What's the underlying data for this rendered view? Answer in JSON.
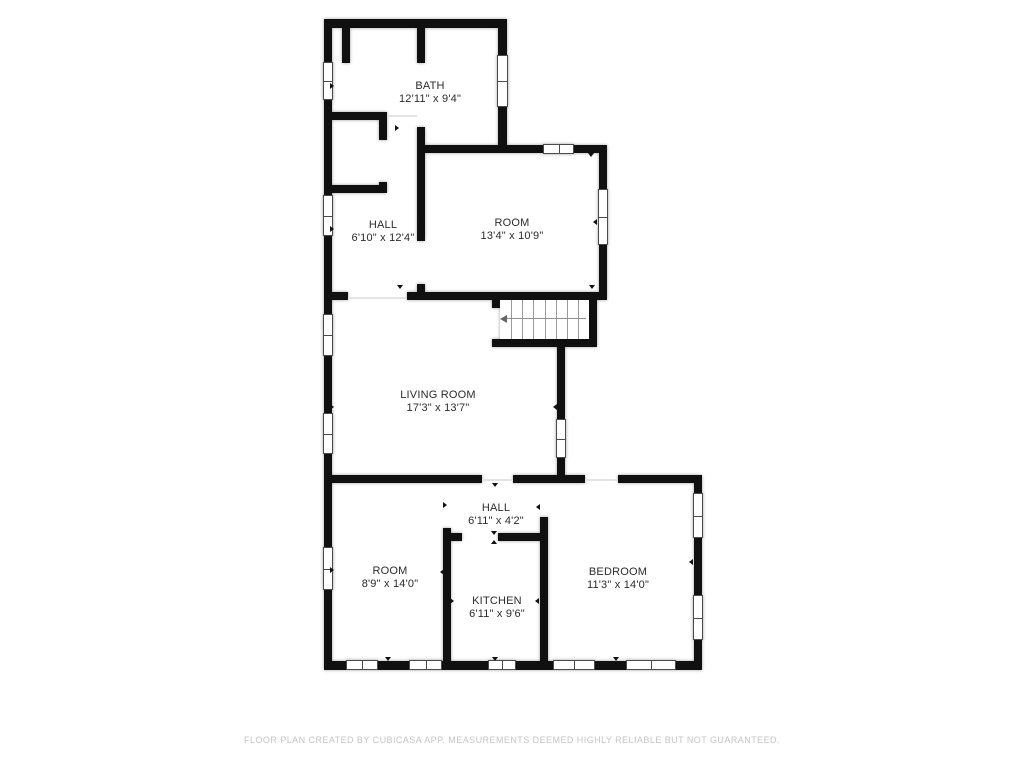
{
  "footer": {
    "text": "FLOOR PLAN CREATED BY CUBICASA APP. MEASUREMENTS DEEMED HIGHLY RELIABLE BUT NOT GUARANTEED."
  },
  "colors": {
    "wall": "#101010",
    "background": "#ffffff",
    "label_text": "#2b2b2b",
    "footer_text": "#c4c4c4",
    "window_frame": "#4a4a4a",
    "stair_tread": "#9a9a9a"
  },
  "floorplan": {
    "rooms": [
      {
        "id": "bath",
        "name": "BATH",
        "dims": "12'11\" x 9'4\"",
        "cx": 430,
        "cy": 93
      },
      {
        "id": "hall-upper",
        "name": "HALL",
        "dims": "6'10\" x 12'4\"",
        "cx": 383,
        "cy": 232
      },
      {
        "id": "room-upper",
        "name": "ROOM",
        "dims": "13'4\" x 10'9\"",
        "cx": 512,
        "cy": 230
      },
      {
        "id": "living-room",
        "name": "LIVING ROOM",
        "dims": "17'3\" x 13'7\"",
        "cx": 438,
        "cy": 402
      },
      {
        "id": "hall-lower",
        "name": "HALL",
        "dims": "6'11\" x 4'2\"",
        "cx": 496,
        "cy": 515
      },
      {
        "id": "room-lower",
        "name": "ROOM",
        "dims": "8'9\" x 14'0\"",
        "cx": 390,
        "cy": 578
      },
      {
        "id": "kitchen",
        "name": "KITCHEN",
        "dims": "6'11\" x 9'6\"",
        "cx": 497,
        "cy": 608
      },
      {
        "id": "bedroom",
        "name": "BEDROOM",
        "dims": "11'3\" x 14'0\"",
        "cx": 618,
        "cy": 579
      }
    ],
    "walls": [
      {
        "x": 324,
        "y": 19,
        "w": 8,
        "h": 650
      },
      {
        "x": 324,
        "y": 19,
        "w": 183,
        "h": 9
      },
      {
        "x": 498,
        "y": 19,
        "w": 9,
        "h": 134
      },
      {
        "x": 498,
        "y": 145,
        "w": 109,
        "h": 8
      },
      {
        "x": 599,
        "y": 145,
        "w": 8,
        "h": 155
      },
      {
        "x": 407,
        "y": 292,
        "w": 200,
        "h": 8
      },
      {
        "x": 589,
        "y": 300,
        "w": 8,
        "h": 47
      },
      {
        "x": 492,
        "y": 339,
        "w": 105,
        "h": 8
      },
      {
        "x": 557,
        "y": 339,
        "w": 8,
        "h": 144
      },
      {
        "x": 324,
        "y": 475,
        "w": 158,
        "h": 8
      },
      {
        "x": 513,
        "y": 475,
        "w": 72,
        "h": 8
      },
      {
        "x": 618,
        "y": 475,
        "w": 84,
        "h": 8
      },
      {
        "x": 694,
        "y": 475,
        "w": 8,
        "h": 194
      },
      {
        "x": 324,
        "y": 661,
        "w": 378,
        "h": 9
      },
      {
        "x": 342,
        "y": 28,
        "w": 8,
        "h": 35
      },
      {
        "x": 417,
        "y": 19,
        "w": 8,
        "h": 44
      },
      {
        "x": 332,
        "y": 112,
        "w": 55,
        "h": 8
      },
      {
        "x": 379,
        "y": 112,
        "w": 8,
        "h": 28
      },
      {
        "x": 379,
        "y": 182,
        "w": 8,
        "h": 11
      },
      {
        "x": 332,
        "y": 185,
        "w": 55,
        "h": 8
      },
      {
        "x": 417,
        "y": 127,
        "w": 8,
        "h": 114
      },
      {
        "x": 417,
        "y": 284,
        "w": 8,
        "h": 16
      },
      {
        "x": 417,
        "y": 145,
        "w": 81,
        "h": 8
      },
      {
        "x": 324,
        "y": 292,
        "w": 24,
        "h": 8
      },
      {
        "x": 492,
        "y": 300,
        "w": 8,
        "h": 8
      },
      {
        "x": 443,
        "y": 528,
        "w": 8,
        "h": 133
      },
      {
        "x": 443,
        "y": 533,
        "w": 19,
        "h": 8
      },
      {
        "x": 498,
        "y": 533,
        "w": 42,
        "h": 8
      },
      {
        "x": 540,
        "y": 517,
        "w": 8,
        "h": 144
      }
    ],
    "windows": [
      {
        "x": 323,
        "y": 62,
        "w": 10,
        "h": 38,
        "o": "v"
      },
      {
        "x": 323,
        "y": 195,
        "w": 10,
        "h": 41,
        "o": "v"
      },
      {
        "x": 323,
        "y": 314,
        "w": 10,
        "h": 42,
        "o": "v"
      },
      {
        "x": 323,
        "y": 413,
        "w": 10,
        "h": 41,
        "o": "v"
      },
      {
        "x": 323,
        "y": 547,
        "w": 10,
        "h": 43,
        "o": "v"
      },
      {
        "x": 497,
        "y": 55,
        "w": 11,
        "h": 52,
        "o": "v"
      },
      {
        "x": 543,
        "y": 144,
        "w": 31,
        "h": 10,
        "o": "h"
      },
      {
        "x": 598,
        "y": 189,
        "w": 10,
        "h": 56,
        "o": "v"
      },
      {
        "x": 556,
        "y": 419,
        "w": 10,
        "h": 39,
        "o": "v"
      },
      {
        "x": 693,
        "y": 493,
        "w": 10,
        "h": 45,
        "o": "v"
      },
      {
        "x": 693,
        "y": 595,
        "w": 10,
        "h": 45,
        "o": "v"
      },
      {
        "x": 346,
        "y": 660,
        "w": 32,
        "h": 10,
        "o": "h"
      },
      {
        "x": 409,
        "y": 660,
        "w": 33,
        "h": 10,
        "o": "h"
      },
      {
        "x": 488,
        "y": 660,
        "w": 28,
        "h": 10,
        "o": "h"
      },
      {
        "x": 553,
        "y": 660,
        "w": 42,
        "h": 10,
        "o": "h"
      },
      {
        "x": 626,
        "y": 660,
        "w": 50,
        "h": 10,
        "o": "h"
      }
    ],
    "stairs": {
      "x": 500,
      "y": 300,
      "w": 89,
      "h": 39,
      "treads": 7,
      "arrow_y": 18
    },
    "thresholds": [
      {
        "x": 348,
        "y": 297,
        "w": 59,
        "h": 2
      },
      {
        "x": 482,
        "y": 479,
        "w": 31,
        "h": 2
      },
      {
        "x": 585,
        "y": 479,
        "w": 33,
        "h": 2
      },
      {
        "x": 387,
        "y": 115,
        "w": 30,
        "h": 2
      }
    ],
    "door_ticks": [
      {
        "x": 433,
        "y": 25,
        "d": "down"
      },
      {
        "x": 398,
        "y": 128,
        "d": "right"
      },
      {
        "x": 421,
        "y": 219,
        "d": "right"
      },
      {
        "x": 400,
        "y": 288,
        "d": "down"
      },
      {
        "x": 591,
        "y": 156,
        "d": "down"
      },
      {
        "x": 596,
        "y": 222,
        "d": "left"
      },
      {
        "x": 592,
        "y": 288,
        "d": "down"
      },
      {
        "x": 333,
        "y": 86,
        "d": "right"
      },
      {
        "x": 333,
        "y": 229,
        "d": "right"
      },
      {
        "x": 333,
        "y": 407,
        "d": "right"
      },
      {
        "x": 556,
        "y": 407,
        "d": "left"
      },
      {
        "x": 495,
        "y": 486,
        "d": "down"
      },
      {
        "x": 446,
        "y": 505,
        "d": "right"
      },
      {
        "x": 539,
        "y": 507,
        "d": "left"
      },
      {
        "x": 494,
        "y": 534,
        "d": "down"
      },
      {
        "x": 494,
        "y": 543,
        "d": "up"
      },
      {
        "x": 388,
        "y": 660,
        "d": "down"
      },
      {
        "x": 495,
        "y": 660,
        "d": "down"
      },
      {
        "x": 616,
        "y": 660,
        "d": "down"
      },
      {
        "x": 333,
        "y": 570,
        "d": "right"
      },
      {
        "x": 443,
        "y": 572,
        "d": "left"
      },
      {
        "x": 453,
        "y": 601,
        "d": "right"
      },
      {
        "x": 538,
        "y": 601,
        "d": "left"
      },
      {
        "x": 547,
        "y": 572,
        "d": "right"
      },
      {
        "x": 692,
        "y": 562,
        "d": "left"
      }
    ]
  }
}
